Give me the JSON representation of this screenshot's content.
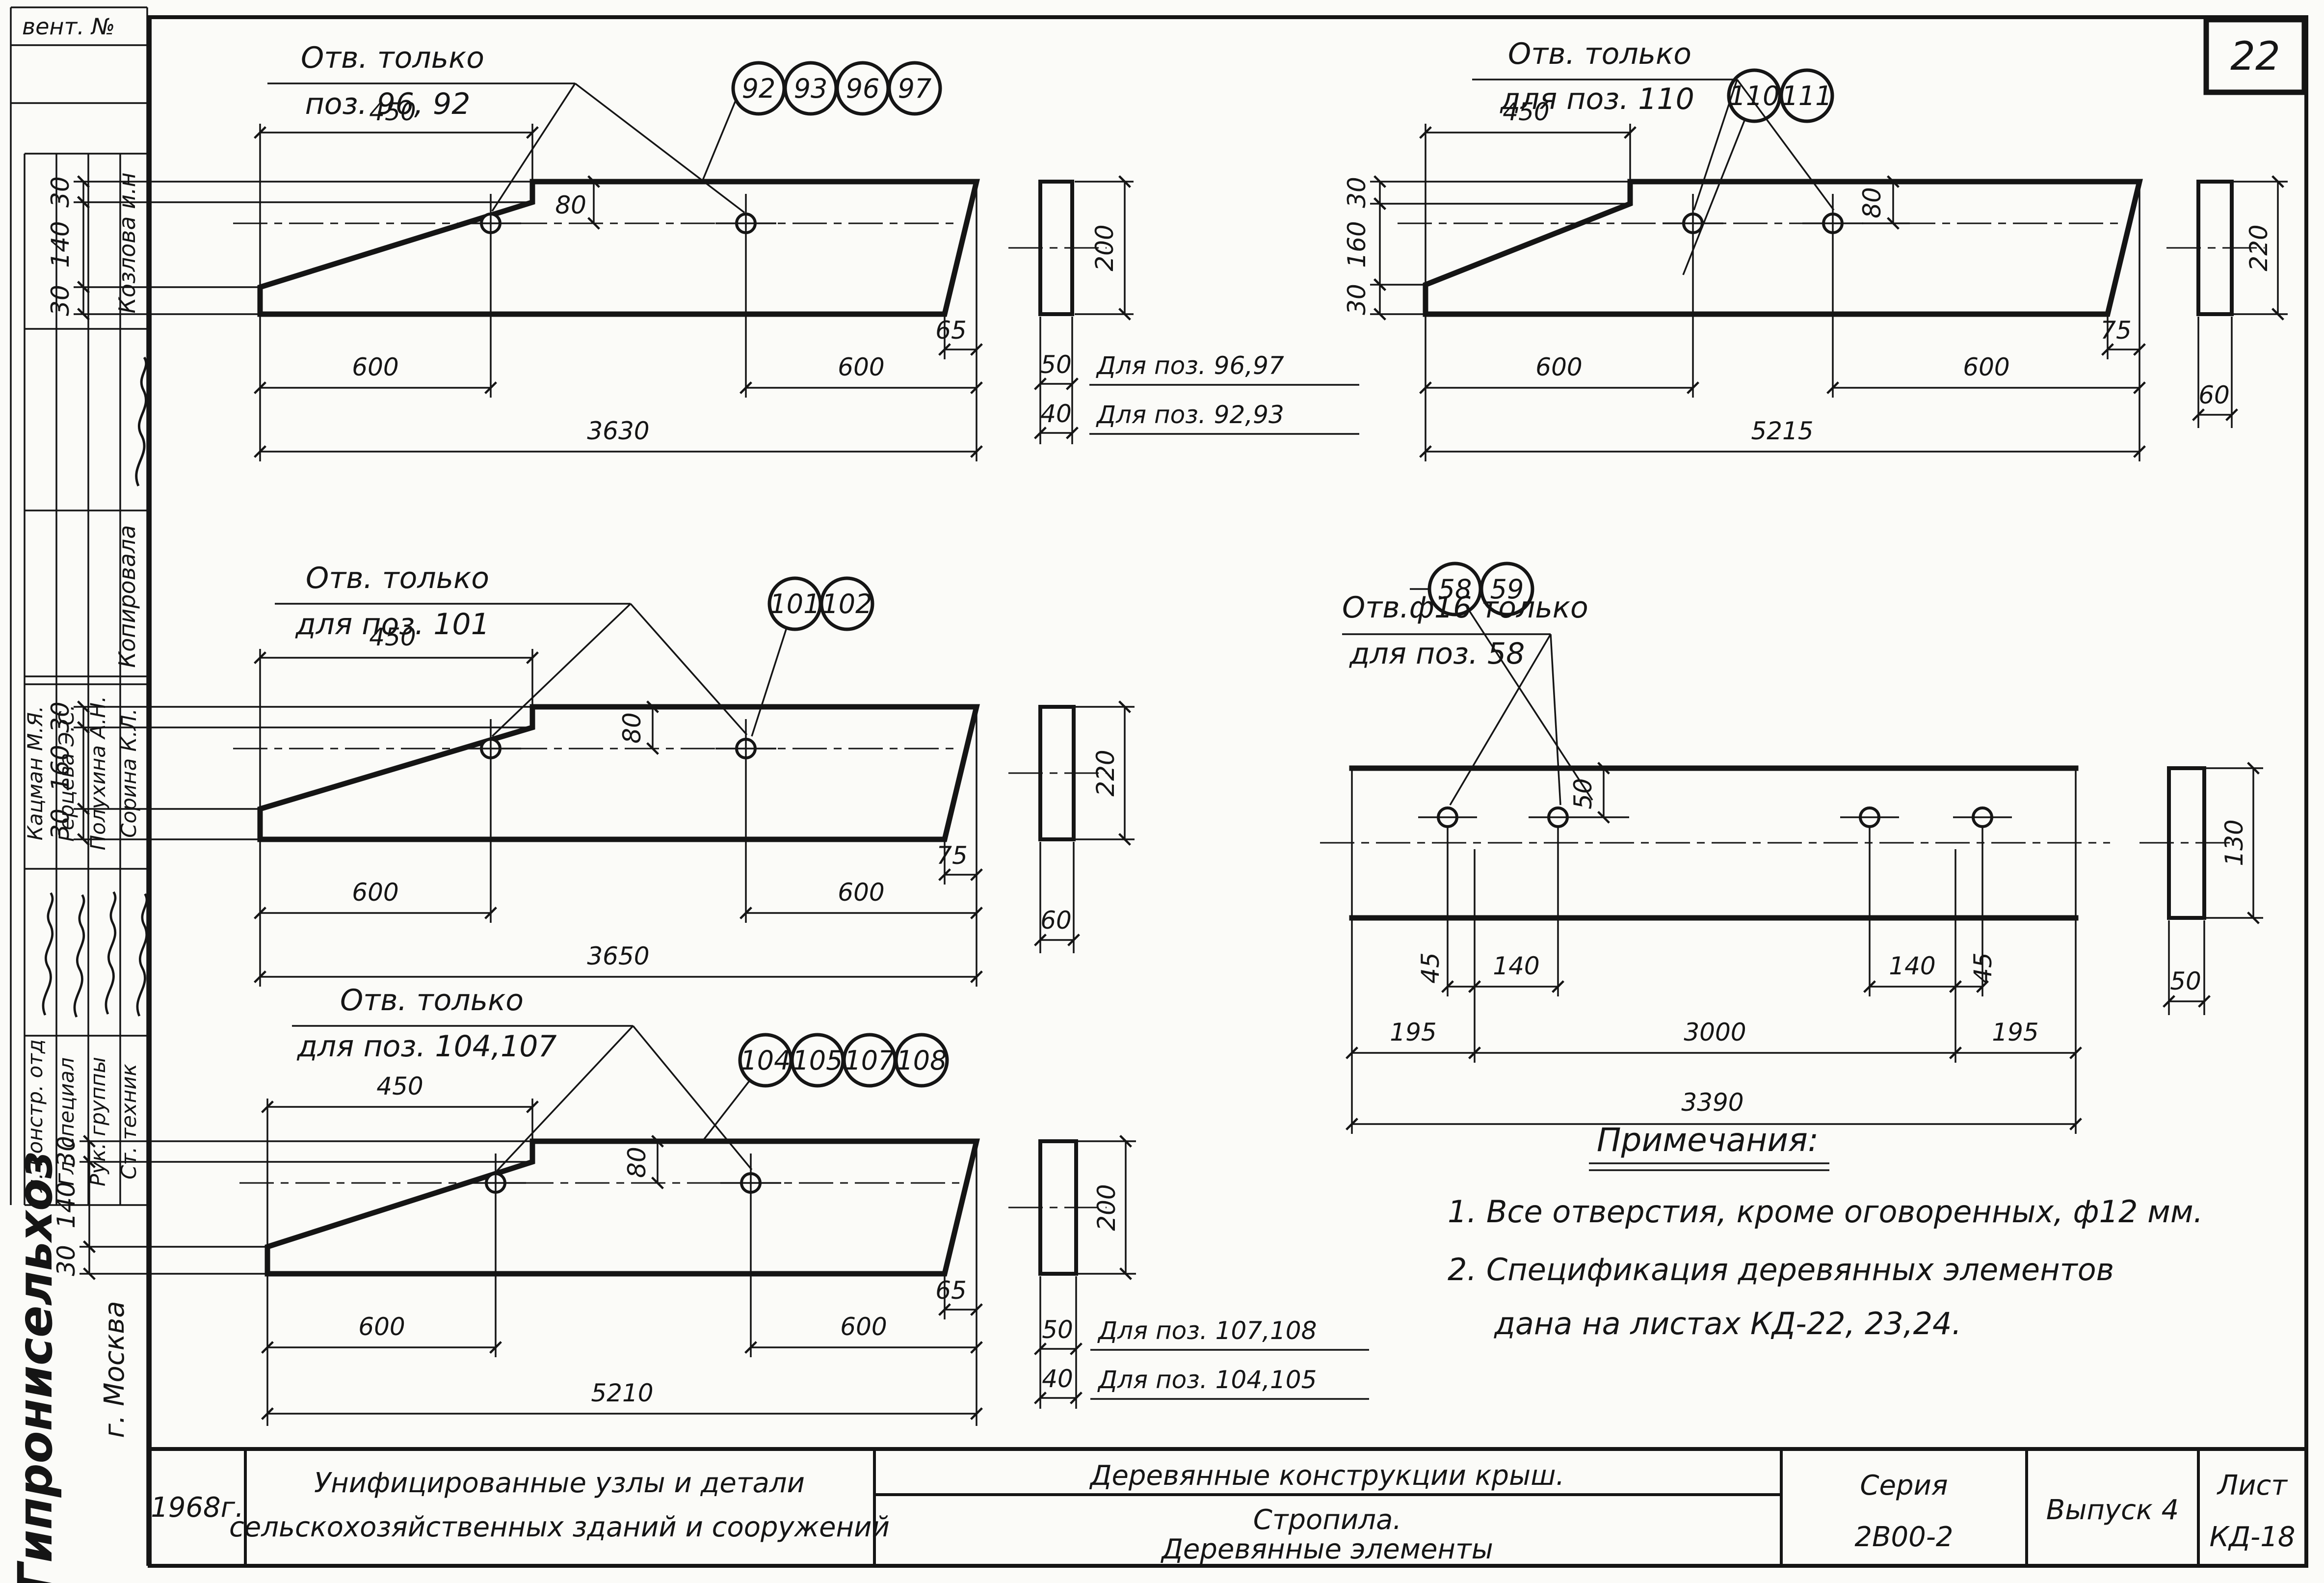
{
  "page": {
    "number": "22"
  },
  "stamp": {
    "vent_label": "вент. №",
    "kopirovala": {
      "role": "Копировала",
      "name": "Козлова и.н"
    },
    "people": [
      {
        "role": "Гл. констр. отд",
        "name": "Кацман М.Я."
      },
      {
        "role": "Гл. специал",
        "name": "Герцева Э.С."
      },
      {
        "role": "Рук. группы",
        "name": "Полухина А.Н."
      },
      {
        "role": "Ст. техник",
        "name": "Сорина К.Л."
      }
    ],
    "organization": "Гипронисельхоз",
    "city": "г. Москва"
  },
  "drawings": [
    {
      "note_line1": "Отв. только",
      "note_line2": "поз. 96, 92",
      "bubbles": [
        "92",
        "93",
        "96",
        "97"
      ],
      "dim_top": "450",
      "dim_left": [
        "30",
        "140",
        "30"
      ],
      "dim_hole": "80",
      "dim_bevel": "65",
      "dim_span1": "600",
      "dim_span2": "600",
      "dim_total": "3630",
      "sec_height": "200",
      "sec_rows": [
        {
          "width": "50",
          "label": "Для поз. 96,97"
        },
        {
          "width": "40",
          "label": "Для поз. 92,93"
        }
      ]
    },
    {
      "note_line1": "Отв. только",
      "note_line2": "для поз. 110",
      "bubbles": [
        "110",
        "111"
      ],
      "dim_top": "450",
      "dim_left": [
        "30",
        "160",
        "30"
      ],
      "dim_hole": "80",
      "dim_bevel": "75",
      "dim_span1": "600",
      "dim_span2": "600",
      "dim_total": "5215",
      "sec_height": "220",
      "sec_width": "60"
    },
    {
      "note_line1": "Отв. только",
      "note_line2": "для поз. 101",
      "bubbles": [
        "101",
        "102"
      ],
      "dim_top": "450",
      "dim_left": [
        "30",
        "160",
        "30"
      ],
      "dim_hole": "80",
      "dim_bevel": "75",
      "dim_span1": "600",
      "dim_span2": "600",
      "dim_total": "3650",
      "sec_height": "220",
      "sec_width": "60"
    },
    {
      "note_line1": "Отв.ф16 только",
      "note_line2": "для поз. 58",
      "bubbles": [
        "58",
        "59"
      ],
      "dim_hole_top": "50",
      "dim_left_pair": [
        "45",
        "140"
      ],
      "dim_right_pair": [
        "140",
        "45"
      ],
      "dim_end_left": "195",
      "dim_mid": "3000",
      "dim_end_right": "195",
      "dim_total": "3390",
      "sec_height": "130",
      "sec_width": "50"
    },
    {
      "note_line1": "Отв. только",
      "note_line2": "для поз. 104,107",
      "bubbles": [
        "104",
        "105",
        "107",
        "108"
      ],
      "dim_top": "450",
      "dim_left": [
        "30",
        "140",
        "30"
      ],
      "dim_hole": "80",
      "dim_bevel": "65",
      "dim_span1": "600",
      "dim_span2": "600",
      "dim_total": "5210",
      "sec_height": "200",
      "sec_rows": [
        {
          "width": "50",
          "label": "Для поз. 107,108"
        },
        {
          "width": "40",
          "label": "Для поз. 104,105"
        }
      ]
    }
  ],
  "notes": {
    "title": "Примечания:",
    "items": [
      "1.   Все отверстия, кроме оговоренных, ф12 мм.",
      "2.   Спецификация деревянных элементов",
      "дана на листах КД-22, 23,24."
    ]
  },
  "title_block": {
    "year": "1968г.",
    "org_line1": "Унифицированные узлы и детали",
    "org_line2": "сельскохозяйственных зданий и сооружений",
    "main_title": "Деревянные конструкции крыш.",
    "sub_title1": "Стропила.",
    "sub_title2": "Деревянные элементы",
    "series_label": "Серия",
    "series_value": "2В00-2",
    "issue": "Выпуск 4",
    "sheet_label": "Лист",
    "sheet_value": "КД-18"
  }
}
